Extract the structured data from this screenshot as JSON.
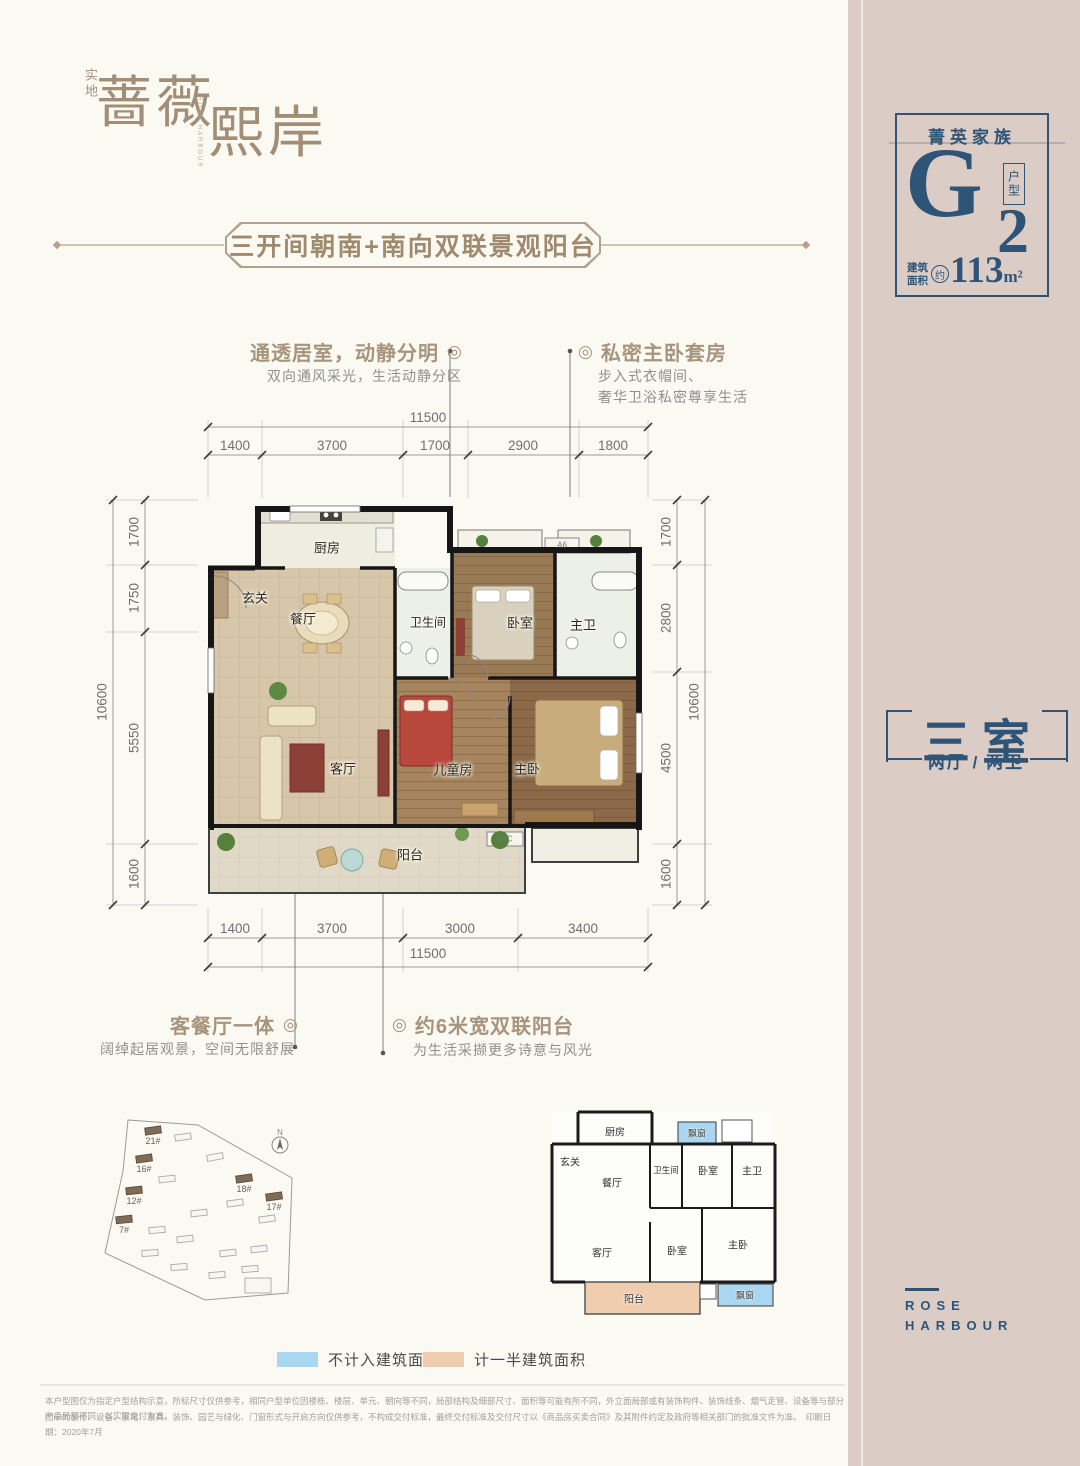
{
  "colors": {
    "accent_blue": "#2e5578",
    "accent_tan": "#a8937c",
    "sidebar_pink": "#dbccc5",
    "legend_blue": "#a9d6f0",
    "legend_tan": "#f1cdb0"
  },
  "brand": {
    "prefix": "实地",
    "name_first": "蔷薇",
    "name_second": "熙岸",
    "english": "ROSE HARBOUR"
  },
  "banner": {
    "title": "三开间朝南+南向双联景观阳台"
  },
  "type_card": {
    "family": "菁英家族",
    "letter": "G",
    "number": "2",
    "type_label": "户型",
    "area_line1": "建筑",
    "area_line2": "面积",
    "approx": "约",
    "area": "113",
    "unit": "m²"
  },
  "callouts": {
    "top_left": {
      "title": "通透居室，动静分明",
      "marker": "◎",
      "desc": "双向通风采光，生活动静分区"
    },
    "top_right": {
      "marker": "◎",
      "title": "私密主卧套房",
      "desc_line1": "步入式衣帽间、",
      "desc_line2": "奢华卫浴私密尊享生活"
    },
    "bottom_left": {
      "title": "客餐厅一体",
      "marker": "◎",
      "desc": "阔绰起居观景，空间无限舒展"
    },
    "bottom_right": {
      "marker": "◎",
      "title": "约6米宽双联阳台",
      "desc": "为生活采撷更多诗意与风光"
    }
  },
  "dims": {
    "top_total": "11500",
    "top_segments": [
      "1400",
      "3700",
      "1700",
      "2900",
      "1800"
    ],
    "left_total": "10600",
    "left_segments": [
      "1700",
      "1750",
      "5550",
      "1600"
    ],
    "right_segments": [
      "1700",
      "2800",
      "4500",
      "1600"
    ],
    "right_total": "10600",
    "bottom_segments": [
      "1400",
      "3700",
      "3000",
      "3400"
    ],
    "bottom_total": "11500"
  },
  "plan": {
    "rooms": {
      "kitchen": "厨房",
      "foyer": "玄关",
      "dining": "餐厅",
      "bath": "卫生间",
      "bedroom": "卧室",
      "master_bath": "主卫",
      "living": "客厅",
      "kids": "儿童房",
      "master": "主卧",
      "balcony": "阳台"
    },
    "annotations": {
      "ac_top": "A6",
      "ac_bottom": "2#C"
    }
  },
  "summary": {
    "main": "三室",
    "sub": "两厅 / 两卫"
  },
  "site_plan": {
    "compass": "N",
    "labels": [
      "21#",
      "16#",
      "12#",
      "7#",
      "18#",
      "17#"
    ]
  },
  "mini_plan": {
    "kitchen": "厨房",
    "foyer": "玄关",
    "dining": "餐厅",
    "bath": "卫生间",
    "bedroom": "卧室",
    "master_bath": "主卫",
    "living": "客厅",
    "bedroom2": "卧室",
    "master": "主卧",
    "balcony": "阳台",
    "bay_top": "飘窗",
    "bay_bottom": "飘窗"
  },
  "legend": {
    "not_counted": "不计入建筑面积",
    "half_counted": "计一半建筑面积"
  },
  "footer": {
    "disclaimer_line1": "本户型图仅为指定户型结构示意，所标尺寸仅供参考，相同户型单位因楼栋、楼层、单元、朝向等不同，局部结构及细部尺寸、面积等可能有所不同，外立面局部或有装饰构件、装饰线条、烟气走管、设备等与部分产品局部不同，以实际交付为准。",
    "disclaimer_line2": "图中的装修、设备、家电、家具、装饰、园艺与绿化、门窗形式与开启方向仅供参考，不构成交付标准，最终交付标准及交付尺寸以《商品房买卖合同》及其附件约定及政府等相关部门的批准文件为准。　印刷日期：2020年7月",
    "english_line1": "ROSE",
    "english_line2": "HARBOUR"
  }
}
